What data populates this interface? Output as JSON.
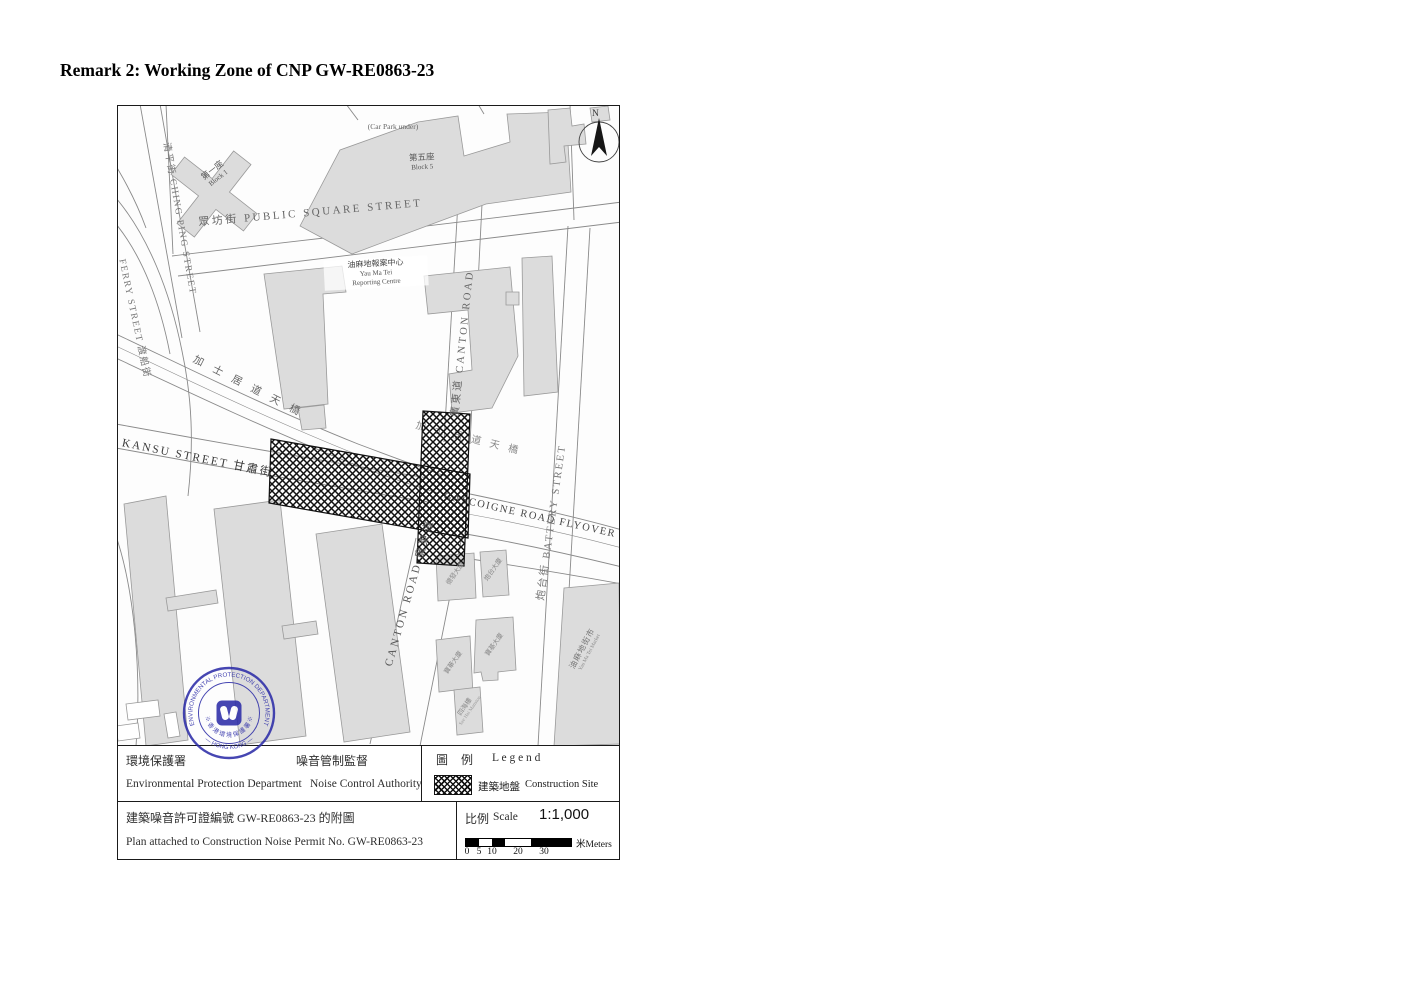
{
  "page": {
    "title": "Remark 2: Working Zone of CNP GW-RE0863-23"
  },
  "map": {
    "north_label": "N",
    "labels": {
      "car_park": "(Car Park under)",
      "block1_zh": "第一座",
      "block1_en": "Block 1",
      "block5_zh": "第五座",
      "block5_en": "Block 5",
      "public_square_street": "眾坊街 PUBLIC SQUARE STREET",
      "ching_ping_street": "清平街 CHING PING STREET",
      "ferry_street": "FERRY STREET 渡船街",
      "canton_road_north": "廣東道 CANTON ROAD",
      "canton_road_south": "CANTON ROAD 廣東道",
      "kansu_street": "KANSU STREET 甘肅街",
      "battery_street": "炮台街 BATTERY STREET",
      "gascoigne_zh_west": "加士居道天橋",
      "gascoigne_zh_mid": "加士居道天橋",
      "gascoigne_en": "GASCOIGNE ROAD FLYOVER",
      "reporting_zh": "油麻地報案中心",
      "reporting_en_1": "Yau Ma Tei",
      "reporting_en_2": "Reporting Centre",
      "market_zh": "油麻地街市",
      "market_en": "Yau Ma Tei Market",
      "bldg_a": "德發大廈",
      "bldg_b": "炮台大廈",
      "bldg_c": "寶基大廈",
      "bldg_d": "寶華大廈",
      "sze_hai_zh": "四海樓",
      "sze_hai_en": "Sze Hai Mansion"
    }
  },
  "stamp": {
    "arc_top": "ENVIRONMENTAL PROTECTION DEPARTMENT",
    "arc_bottom": "— HONG KONG —",
    "inner_arc": "※ 香 港 環 境 保 護 署 ※"
  },
  "panel": {
    "dept_zh": "環境保護署",
    "nca_zh": "噪音管制監督",
    "dept_en": "Environmental Protection Department",
    "nca_en": "Noise Control Authority",
    "legend_title_zh": "圖 例",
    "legend_title_en": "L e g e n d",
    "legend_item_zh": "建築地盤",
    "legend_item_en": "Construction Site",
    "permit_zh": "建築噪音許可證編號 GW-RE0863-23 的附圖",
    "permit_en": "Plan attached to Construction Noise Permit No. GW-RE0863-23",
    "scale_zh": "比例",
    "scale_en": "Scale",
    "scale_value": "1:1,000",
    "ticks": [
      "0",
      "5",
      "10",
      "20",
      "30"
    ],
    "unit": "米Meters"
  },
  "colors": {
    "stamp_blue": "#2d2da8",
    "building_gray": "#dcdcdc",
    "hatch_black": "#111111",
    "road_line_gray": "#8a8a8a"
  }
}
